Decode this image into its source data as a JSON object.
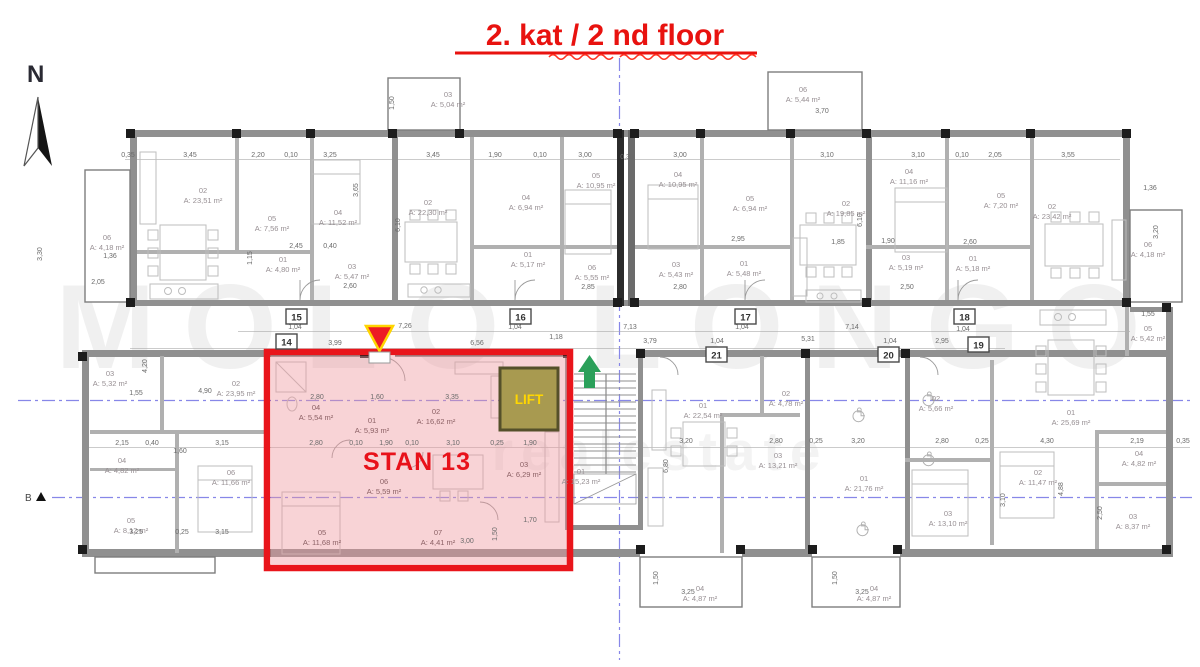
{
  "title": "2. kat / 2 nd floor",
  "compass": {
    "label": "N"
  },
  "section_marker": {
    "label": "B"
  },
  "watermark": {
    "primary": "MOLO LONGO",
    "secondary": "realestate"
  },
  "highlight": {
    "apartment_label": "STAN 13",
    "lift_label": "LIFT",
    "border_color": "#e9151b",
    "fill_color": "rgba(238,150,158,0.42)"
  },
  "colors": {
    "title_red": "#e8120f",
    "axis_blue": "#8787e8",
    "arrow_green": "#2ba05a",
    "marker_yellow": "#ffd500",
    "lift_olive": "#a89a50"
  },
  "corridor_units": [
    {
      "no": "15",
      "x": 286,
      "y": 309
    },
    {
      "no": "14",
      "x": 276,
      "y": 334
    },
    {
      "no": "16",
      "x": 510,
      "y": 309
    },
    {
      "no": "17",
      "x": 735,
      "y": 309
    },
    {
      "no": "18",
      "x": 954,
      "y": 309
    },
    {
      "no": "19",
      "x": 968,
      "y": 337
    },
    {
      "no": "20",
      "x": 878,
      "y": 347
    },
    {
      "no": "21",
      "x": 706,
      "y": 347
    }
  ],
  "rooms": [
    {
      "apt": "upper-far-left",
      "id": "06",
      "area": "A: 4,18 m²",
      "x": 107,
      "y": 240
    },
    {
      "apt": "upper-far-left",
      "id": "02",
      "area": "A: 23,51 m²",
      "x": 203,
      "y": 193
    },
    {
      "apt": "upper-far-left",
      "id": "05",
      "area": "A: 7,56 m²",
      "x": 272,
      "y": 221
    },
    {
      "apt": "upper-far-left",
      "id": "04",
      "area": "A: 11,52 m²",
      "x": 338,
      "y": 215
    },
    {
      "apt": "upper-far-left",
      "id": "01",
      "area": "A: 4,80 m²",
      "x": 283,
      "y": 262
    },
    {
      "apt": "upper-far-left",
      "id": "03",
      "area": "A: 5,47 m²",
      "x": 352,
      "y": 269
    },
    {
      "apt": "upper-center-left",
      "id": "03",
      "area": "A: 5,04 m²",
      "x": 448,
      "y": 97
    },
    {
      "apt": "upper-center-left",
      "id": "02",
      "area": "A: 22,30 m²",
      "x": 428,
      "y": 205
    },
    {
      "apt": "upper-center-left",
      "id": "04",
      "area": "A: 6,94 m²",
      "x": 526,
      "y": 200
    },
    {
      "apt": "upper-center-left",
      "id": "05",
      "area": "A: 10,95 m²",
      "x": 596,
      "y": 178
    },
    {
      "apt": "upper-center-left",
      "id": "01",
      "area": "A: 5,17 m²",
      "x": 528,
      "y": 257
    },
    {
      "apt": "upper-center-left",
      "id": "06",
      "area": "A: 5,55 m²",
      "x": 592,
      "y": 270
    },
    {
      "apt": "upper-center-right",
      "id": "06",
      "area": "A: 5,44 m²",
      "x": 803,
      "y": 92
    },
    {
      "apt": "upper-center-right",
      "id": "04",
      "area": "A: 10,95 m²",
      "x": 678,
      "y": 177
    },
    {
      "apt": "upper-center-right",
      "id": "05",
      "area": "A: 6,94 m²",
      "x": 750,
      "y": 201
    },
    {
      "apt": "upper-center-right",
      "id": "02",
      "area": "A: 19,85 m²",
      "x": 846,
      "y": 206
    },
    {
      "apt": "upper-center-right",
      "id": "03",
      "area": "A: 5,43 m²",
      "x": 676,
      "y": 267
    },
    {
      "apt": "upper-center-right",
      "id": "01",
      "area": "A: 5,48 m²",
      "x": 744,
      "y": 266
    },
    {
      "apt": "upper-far-right",
      "id": "04",
      "area": "A: 11,16 m²",
      "x": 909,
      "y": 174
    },
    {
      "apt": "upper-far-right",
      "id": "05",
      "area": "A: 7,20 m²",
      "x": 1001,
      "y": 198
    },
    {
      "apt": "upper-far-right",
      "id": "02",
      "area": "A: 23,42 m²",
      "x": 1052,
      "y": 209
    },
    {
      "apt": "upper-far-right",
      "id": "03",
      "area": "A: 5,19 m²",
      "x": 906,
      "y": 260
    },
    {
      "apt": "upper-far-right",
      "id": "01",
      "area": "A: 5,18 m²",
      "x": 973,
      "y": 261
    },
    {
      "apt": "upper-far-right",
      "id": "06",
      "area": "A: 4,18 m²",
      "x": 1148,
      "y": 247
    },
    {
      "apt": "lower-far-left",
      "id": "03",
      "area": "A: 5,32 m²",
      "x": 110,
      "y": 376
    },
    {
      "apt": "lower-far-left",
      "id": "02",
      "area": "A: 23,95 m²",
      "x": 236,
      "y": 386
    },
    {
      "apt": "lower-far-left",
      "id": "04",
      "area": "A: 4,82 m²",
      "x": 122,
      "y": 463
    },
    {
      "apt": "lower-far-left",
      "id": "06",
      "area": "A: 11,66 m²",
      "x": 231,
      "y": 475
    },
    {
      "apt": "lower-far-left",
      "id": "05",
      "area": "A: 8,12 m²",
      "x": 131,
      "y": 523
    },
    {
      "apt": "stan-13",
      "id": "04",
      "area": "A: 5,54 m²",
      "x": 316,
      "y": 410,
      "hl": true
    },
    {
      "apt": "stan-13",
      "id": "01",
      "area": "A: 5,93 m²",
      "x": 372,
      "y": 423,
      "hl": true
    },
    {
      "apt": "stan-13",
      "id": "02",
      "area": "A: 16,62 m²",
      "x": 436,
      "y": 414,
      "hl": true
    },
    {
      "apt": "stan-13",
      "id": "06",
      "area": "A: 5,59 m²",
      "x": 384,
      "y": 484,
      "hl": true
    },
    {
      "apt": "stan-13",
      "id": "05",
      "area": "A: 11,68 m²",
      "x": 322,
      "y": 535,
      "hl": true
    },
    {
      "apt": "stan-13",
      "id": "07",
      "area": "A: 4,41 m²",
      "x": 438,
      "y": 535,
      "hl": true
    },
    {
      "apt": "stan-13",
      "id": "03",
      "area": "A: 6,29 m²",
      "x": 524,
      "y": 467,
      "hl": true
    },
    {
      "apt": "stairwell",
      "id": "01",
      "area": "A: 15,23 m²",
      "x": 581,
      "y": 474
    },
    {
      "apt": "lower-center-left",
      "id": "01",
      "area": "A: 22,54 m²",
      "x": 703,
      "y": 408
    },
    {
      "apt": "lower-center-left",
      "id": "02",
      "area": "A: 4,78 m²",
      "x": 786,
      "y": 396
    },
    {
      "apt": "lower-center-left",
      "id": "03",
      "area": "A: 13,21 m²",
      "x": 778,
      "y": 458
    },
    {
      "apt": "lower-center-left",
      "id": "04",
      "area": "A: 4,87 m²",
      "x": 700,
      "y": 591
    },
    {
      "apt": "lower-center-right",
      "id": "01",
      "area": "A: 21,76 m²",
      "x": 864,
      "y": 481
    },
    {
      "apt": "lower-center-right",
      "id": "04",
      "area": "A: 4,87 m²",
      "x": 874,
      "y": 591
    },
    {
      "apt": "lower-far-right",
      "id": "02",
      "area": "A: 5,66 m²",
      "x": 936,
      "y": 401
    },
    {
      "apt": "lower-far-right",
      "id": "01",
      "area": "A: 25,69 m²",
      "x": 1071,
      "y": 415
    },
    {
      "apt": "lower-far-right",
      "id": "02",
      "area": "A: 11,47 m²",
      "x": 1038,
      "y": 475
    },
    {
      "apt": "lower-far-right",
      "id": "03",
      "area": "A: 13,10 m²",
      "x": 948,
      "y": 516
    },
    {
      "apt": "lower-far-right",
      "id": "04",
      "area": "A: 4,82 m²",
      "x": 1139,
      "y": 456
    },
    {
      "apt": "lower-far-right",
      "id": "03",
      "area": "A: 8,37 m²",
      "x": 1133,
      "y": 519
    },
    {
      "apt": "lower-far-right",
      "id": "05",
      "area": "A: 5,42 m²",
      "x": 1148,
      "y": 331
    }
  ],
  "dimensions": [
    [
      "0,35",
      128,
      157
    ],
    [
      "3,45",
      190,
      157
    ],
    [
      "2,20",
      258,
      157
    ],
    [
      "0,10",
      291,
      157
    ],
    [
      "3,25",
      330,
      157
    ],
    [
      "3,45",
      433,
      157
    ],
    [
      "1,90",
      495,
      157
    ],
    [
      "0,10",
      540,
      157
    ],
    [
      "3,00",
      585,
      157
    ],
    [
      "0,30",
      627,
      159
    ],
    [
      "3,00",
      680,
      157
    ],
    [
      "3,10",
      827,
      157
    ],
    [
      "3,10",
      918,
      157
    ],
    [
      "0,10",
      962,
      157
    ],
    [
      "2,05",
      995,
      157
    ],
    [
      "3,55",
      1068,
      157
    ],
    [
      "3,70",
      822,
      113
    ],
    [
      "1,36",
      1150,
      190
    ],
    [
      "1,50",
      394,
      103,
      1
    ],
    [
      "3,65",
      358,
      190,
      1
    ],
    [
      "6,10",
      400,
      225,
      1
    ],
    [
      "6,10",
      862,
      220,
      1
    ],
    [
      "3,20",
      1158,
      232,
      1
    ],
    [
      "3,30",
      42,
      254,
      1
    ],
    [
      "1,36",
      110,
      258
    ],
    [
      "2,05",
      98,
      284
    ],
    [
      "2,45",
      296,
      248
    ],
    [
      "0,40",
      330,
      248
    ],
    [
      "2,60",
      350,
      288
    ],
    [
      "1,15",
      252,
      258,
      1
    ],
    [
      "2,85",
      588,
      289
    ],
    [
      "2,80",
      680,
      289
    ],
    [
      "2,95",
      738,
      241
    ],
    [
      "1,85",
      838,
      244
    ],
    [
      "1,90",
      888,
      243
    ],
    [
      "2,60",
      970,
      244
    ],
    [
      "2,50",
      907,
      289
    ],
    [
      "1,04",
      295,
      329
    ],
    [
      "7,26",
      405,
      328
    ],
    [
      "1,04",
      515,
      329
    ],
    [
      "7,13",
      630,
      329
    ],
    [
      "1,04",
      742,
      329
    ],
    [
      "7,14",
      852,
      329
    ],
    [
      "1,04",
      963,
      331
    ],
    [
      "3,99",
      335,
      345
    ],
    [
      "6,56",
      477,
      345
    ],
    [
      "1,18",
      556,
      339
    ],
    [
      "3,79",
      650,
      343
    ],
    [
      "1,04",
      717,
      343
    ],
    [
      "5,31",
      808,
      341
    ],
    [
      "1,04",
      890,
      343
    ],
    [
      "2,95",
      942,
      343
    ],
    [
      "1,55",
      1148,
      316
    ],
    [
      "2,80",
      317,
      399
    ],
    [
      "1,60",
      377,
      399
    ],
    [
      "3,35",
      452,
      399
    ],
    [
      "2,80",
      316,
      445
    ],
    [
      "0,10",
      356,
      445
    ],
    [
      "1,90",
      386,
      445
    ],
    [
      "0,10",
      412,
      445
    ],
    [
      "3,10",
      453,
      445
    ],
    [
      "0,25",
      497,
      445
    ],
    [
      "1,90",
      530,
      445
    ],
    [
      "1,70",
      530,
      522
    ],
    [
      "3,00",
      467,
      543
    ],
    [
      "1,50",
      497,
      534,
      1
    ],
    [
      "1,55",
      136,
      395
    ],
    [
      "4,90",
      205,
      393
    ],
    [
      "4,20",
      147,
      366,
      1
    ],
    [
      "2,15",
      122,
      445
    ],
    [
      "0,40",
      152,
      445
    ],
    [
      "1,60",
      180,
      453
    ],
    [
      "3,15",
      222,
      445
    ],
    [
      "3,25",
      136,
      534
    ],
    [
      "0,25",
      182,
      534
    ],
    [
      "3,15",
      222,
      534
    ],
    [
      "3,20",
      686,
      443
    ],
    [
      "2,80",
      776,
      443
    ],
    [
      "0,25",
      816,
      443
    ],
    [
      "3,20",
      858,
      443
    ],
    [
      "6,80",
      668,
      466,
      1
    ],
    [
      "2,80",
      942,
      443
    ],
    [
      "0,25",
      982,
      443
    ],
    [
      "4,30",
      1047,
      443
    ],
    [
      "2,19",
      1137,
      443
    ],
    [
      "0,35",
      1183,
      443
    ],
    [
      "4,88",
      1063,
      489,
      1
    ],
    [
      "3,10",
      1005,
      500,
      1
    ],
    [
      "2,50",
      1102,
      513,
      1
    ],
    [
      "3,25",
      688,
      594
    ],
    [
      "1,50",
      658,
      578,
      1
    ],
    [
      "3,25",
      862,
      594
    ],
    [
      "1,50",
      837,
      578,
      1
    ]
  ]
}
